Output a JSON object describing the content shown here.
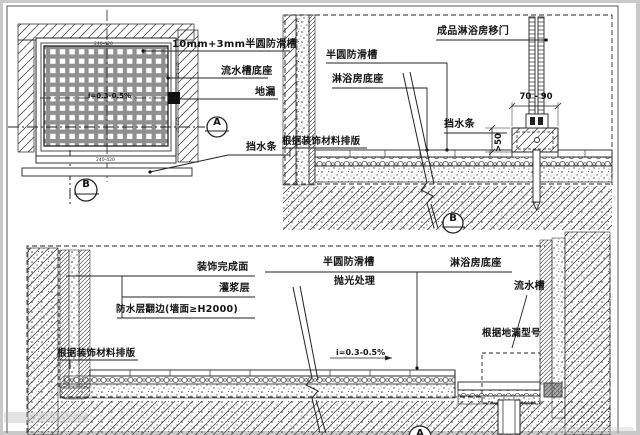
{
  "drawing": {
    "type": "CAD shower-room floor construction detail",
    "colors": {
      "paper": "#ffffff",
      "line": "#222222",
      "hatch": "#4a4a4a",
      "rim": "#c9c9c9",
      "grate_bar": "#8f8f8f"
    }
  },
  "plan": {
    "labels": {
      "groove": "10mm+3mm半圆防滑槽",
      "channel_base": "流水槽底座",
      "drain": "地漏",
      "water_bar": "挡水条"
    },
    "bubbles": {
      "a": "A",
      "b": "B"
    },
    "dims": {
      "top": "240-420",
      "bottom": "240-420",
      "right_upper": "25-125",
      "right_lower": "25-125"
    },
    "slope": "i=0.3-0.5%"
  },
  "section_b": {
    "labels": {
      "door": "成品淋浴房移门",
      "groove": "半圆防滑槽",
      "shower_base": "淋浴房底座",
      "water_bar": "挡水条",
      "wall_finish": "根据装饰材料排版"
    },
    "dims": {
      "width": "70 - 90",
      "height": ">50"
    },
    "bubble": "B"
  },
  "section_a": {
    "labels": {
      "finish_surface": "装饰完成面",
      "grout": "灌浆层",
      "waterproof": "防水层翻边(墙面≥H2000)",
      "wall_finish": "根据装饰材料排版",
      "groove": "半圆防滑槽",
      "polish": "抛光处理",
      "shower_base": "淋浴房底座",
      "water_channel": "流水槽",
      "drain_model": "根据地漏型号",
      "slope": "i=0.3-0.5%"
    },
    "bubble": "A"
  }
}
